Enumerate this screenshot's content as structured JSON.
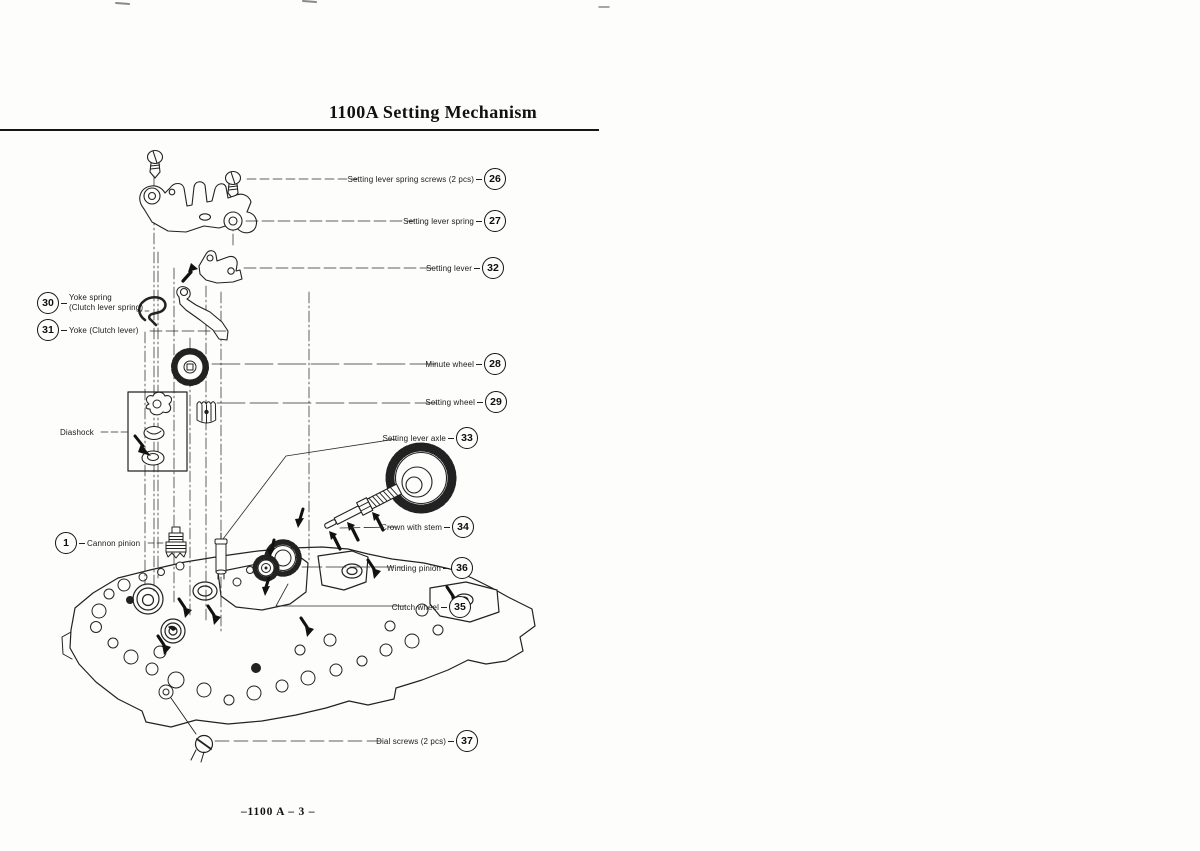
{
  "page": {
    "title": "1100A Setting Mechanism",
    "footer": "–1100 A – 3 –"
  },
  "labels": {
    "screws26": {
      "text": "Setting lever spring screws (2 pcs)",
      "num": "26"
    },
    "spring27": {
      "text": "Setting lever spring",
      "num": "27"
    },
    "lever32": {
      "text": "Setting lever",
      "num": "32"
    },
    "yokeSpring30": {
      "line1": "Yoke spring",
      "line2": "(Clutch lever spring)",
      "num": "30"
    },
    "yoke31": {
      "text": "Yoke (Clutch lever)",
      "num": "31"
    },
    "minute28": {
      "text": "Minute wheel",
      "num": "28"
    },
    "setting29": {
      "text": "Setting wheel",
      "num": "29"
    },
    "diashock": {
      "text": "Diashock"
    },
    "axle33": {
      "text": "Setting lever axle",
      "num": "33"
    },
    "cannon1": {
      "text": "Cannon pinion",
      "num": "1"
    },
    "crown34": {
      "text": "Crown with stem",
      "num": "34"
    },
    "winding36": {
      "text": "Winding pinion",
      "num": "36"
    },
    "clutch35": {
      "text": "Clutch wheel",
      "num": "35"
    },
    "dial37": {
      "text": "Dial screws (2 pcs)",
      "num": "37"
    }
  }
}
